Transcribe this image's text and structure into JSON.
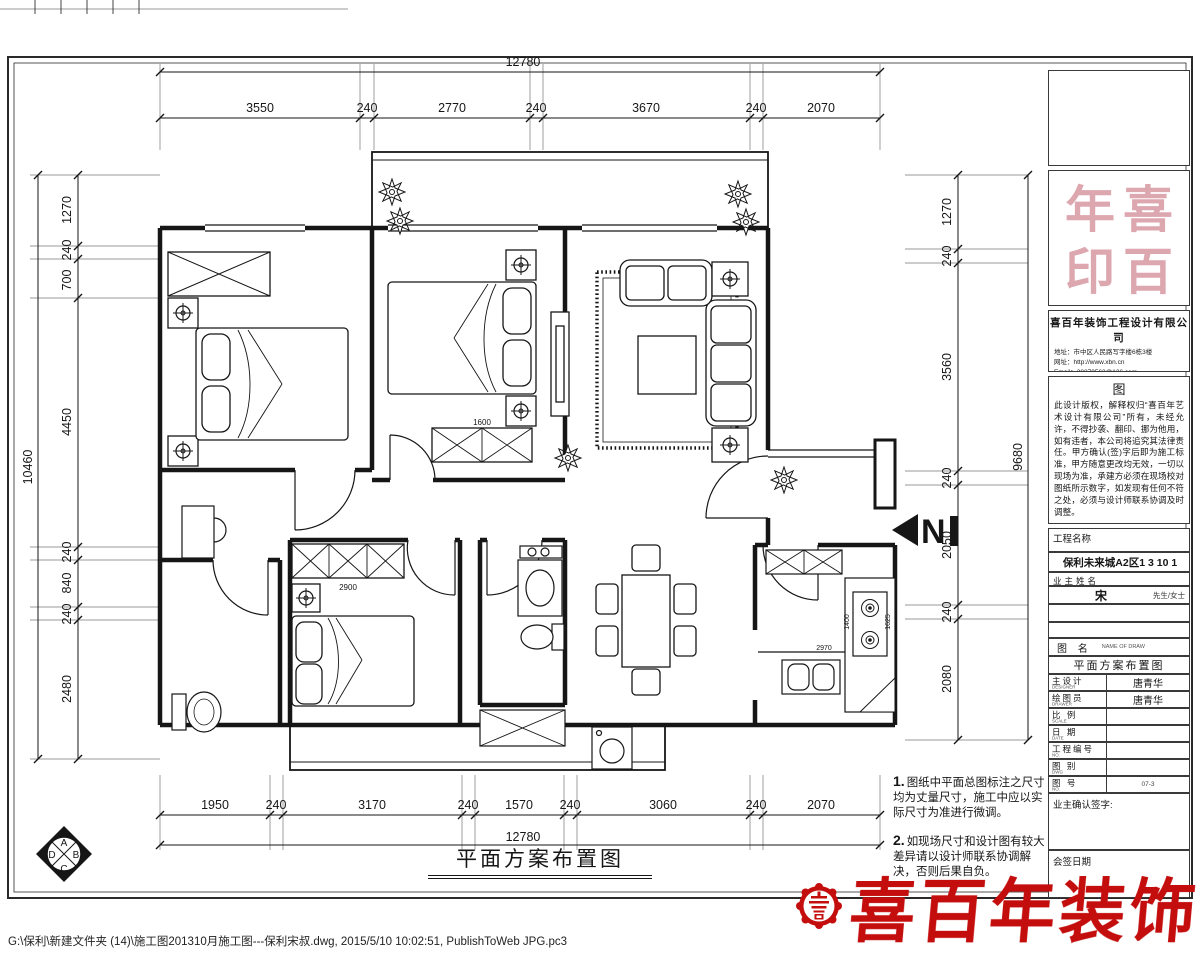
{
  "sheet": {
    "plan_title": "平面方案布置图",
    "footer": "G:\\保利\\新建文件夹 (14)\\施工图201310月施工图---保利宋叔.dwg, 2015/5/10 10:02:51, PublishToWeb JPG.pc3"
  },
  "dims": {
    "top": {
      "overall": "12780",
      "segments": [
        "3550",
        "240",
        "2770",
        "240",
        "3670",
        "240",
        "2070"
      ]
    },
    "bottom": {
      "overall": "12780",
      "segments": [
        "1950",
        "240",
        "3170",
        "240",
        "1570",
        "240",
        "3060",
        "240",
        "2070"
      ]
    },
    "left": {
      "overall": "10460",
      "segments": [
        "1270",
        "240",
        "700",
        "4450",
        "240",
        "840",
        "240",
        "2480"
      ]
    },
    "right": {
      "overall": "9680",
      "segments": [
        "1270",
        "240",
        "3560",
        "240",
        "2050",
        "240",
        "2080"
      ]
    }
  },
  "plan": {
    "north": "N",
    "labels": {
      "b2_wardrobe": "1600",
      "b3_wardrobe": "2900",
      "kitchen_left": "1400",
      "kitchen_right": "1625",
      "kitchen_bottom": "2970"
    }
  },
  "orient": {
    "top": "A",
    "right": "B",
    "bottom": "C",
    "left": "D"
  },
  "notes": {
    "n1_no": "1.",
    "n1": "图纸中平面总图标注之尺寸均为丈量尺寸，施工中应以实际尺寸为准进行微调。",
    "n2_no": "2.",
    "n2": "如现场尺寸和设计图有较大差异请以设计师联系协调解决，否则后果自负。"
  },
  "tb": {
    "seal_chars": [
      "年",
      "喜",
      "印",
      "百"
    ],
    "company": {
      "name": "喜百年装饰工程设计有限公司",
      "address": "地址：市中区人民路写字楼6栋3楼",
      "web": "网址：http://www.xbn.cn",
      "email": "Email：28270563@126.com",
      "tel": "TEL：(0832)-6324638"
    },
    "copyright": {
      "heading": "图",
      "body": "此设计版权，解释权归“喜百年艺术设计有限公司”所有，未经允许，不得抄袭、翻印、挪为他用，如有违者，本公司将追究其法律责任。甲方确认(签)字后即为施工标准，甲方随意更改均无效，一切以现场为准，承建方必须在现场校对图纸所示数字，如发现有任何不符之处，必须与设计师联系协调及时调整。"
    },
    "project_label": "工程名称",
    "project_value": "保利未来城A2区1 3 10 1",
    "owner_label": "业主姓名",
    "owner_value": "宋",
    "owner_suffix": "先生/女士",
    "drawing_label": "图  名",
    "drawing_sub": "NAME OF DRAW",
    "drawing_value": "平面方案布置图",
    "rows": [
      {
        "label": "主设计",
        "sub": "DESIGNER",
        "value": "唐青华"
      },
      {
        "label": "绘图员",
        "sub": "DRAWER",
        "value": "唐青华"
      },
      {
        "label": "比 例",
        "sub": "SCALE",
        "value": ""
      },
      {
        "label": "日 期",
        "sub": "DATE",
        "value": ""
      },
      {
        "label": "工程编号",
        "sub": "NO.",
        "value": ""
      },
      {
        "label": "图 别",
        "sub": "DWG",
        "value": ""
      },
      {
        "label": "图 号",
        "sub": "NO.",
        "value": "07-3"
      }
    ],
    "confirm_label": "业主确认签字:",
    "countersign_label": "会签日期"
  },
  "logo": {
    "text": "喜百年装饰"
  }
}
